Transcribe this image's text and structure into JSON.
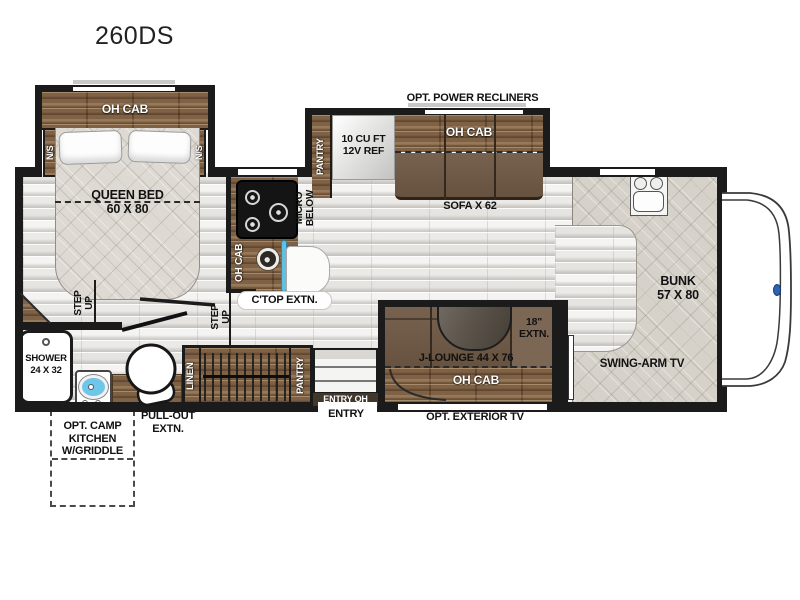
{
  "title": "260DS",
  "colors": {
    "wall": "#1b1b1b",
    "wood": "#7f6245",
    "cushion": "#6e5949",
    "mattress": "#dedad3",
    "floor": "#efeeec",
    "sink_blue": "#6ec6e8",
    "badge_blue": "#2f62b0"
  },
  "bedroom": {
    "oh_cab": "OH CAB",
    "nightstand_left": "N/S",
    "nightstand_right": "N/S",
    "bed_name": "QUEEN BED",
    "bed_size": "60 X 80",
    "step_up_line1": "STEP",
    "step_up_line2": "UP"
  },
  "bathroom": {
    "shower_name": "SHOWER",
    "shower_size": "24 X 32"
  },
  "galley": {
    "step_up_line1": "STEP",
    "step_up_line2": "UP",
    "oh_cab": "OH CAB",
    "micro_line1": "MICRO",
    "micro_line2": "BELOW",
    "ctop_extn": "C'TOP EXTN.",
    "linen": "LINEN",
    "wardrobe_pantry": "PANTRY",
    "entry_oh": "ENTRY OH",
    "entry": "ENTRY"
  },
  "sofa_slide": {
    "option": "OPT. POWER RECLINERS",
    "pantry": "PANTRY",
    "fridge_line1": "10 CU FT",
    "fridge_line2": "12V REF",
    "oh_cab": "OH CAB",
    "sofa": "SOFA X 62"
  },
  "dinette": {
    "name": "J-LOUNGE 44 X 76",
    "extn_line1": "18\"",
    "extn_line2": "EXTN.",
    "oh_cab": "OH CAB",
    "exterior_tv": "OPT. EXTERIOR TV"
  },
  "front": {
    "bunk_name": "BUNK",
    "bunk_size": "57 X 80",
    "swing_tv": "SWING-ARM TV"
  },
  "exterior": {
    "camp_line1": "OPT. CAMP",
    "camp_line2": "KITCHEN",
    "camp_line3": "W/GRIDDLE",
    "pullout_line1": "PULL-OUT",
    "pullout_line2": "EXTN."
  }
}
